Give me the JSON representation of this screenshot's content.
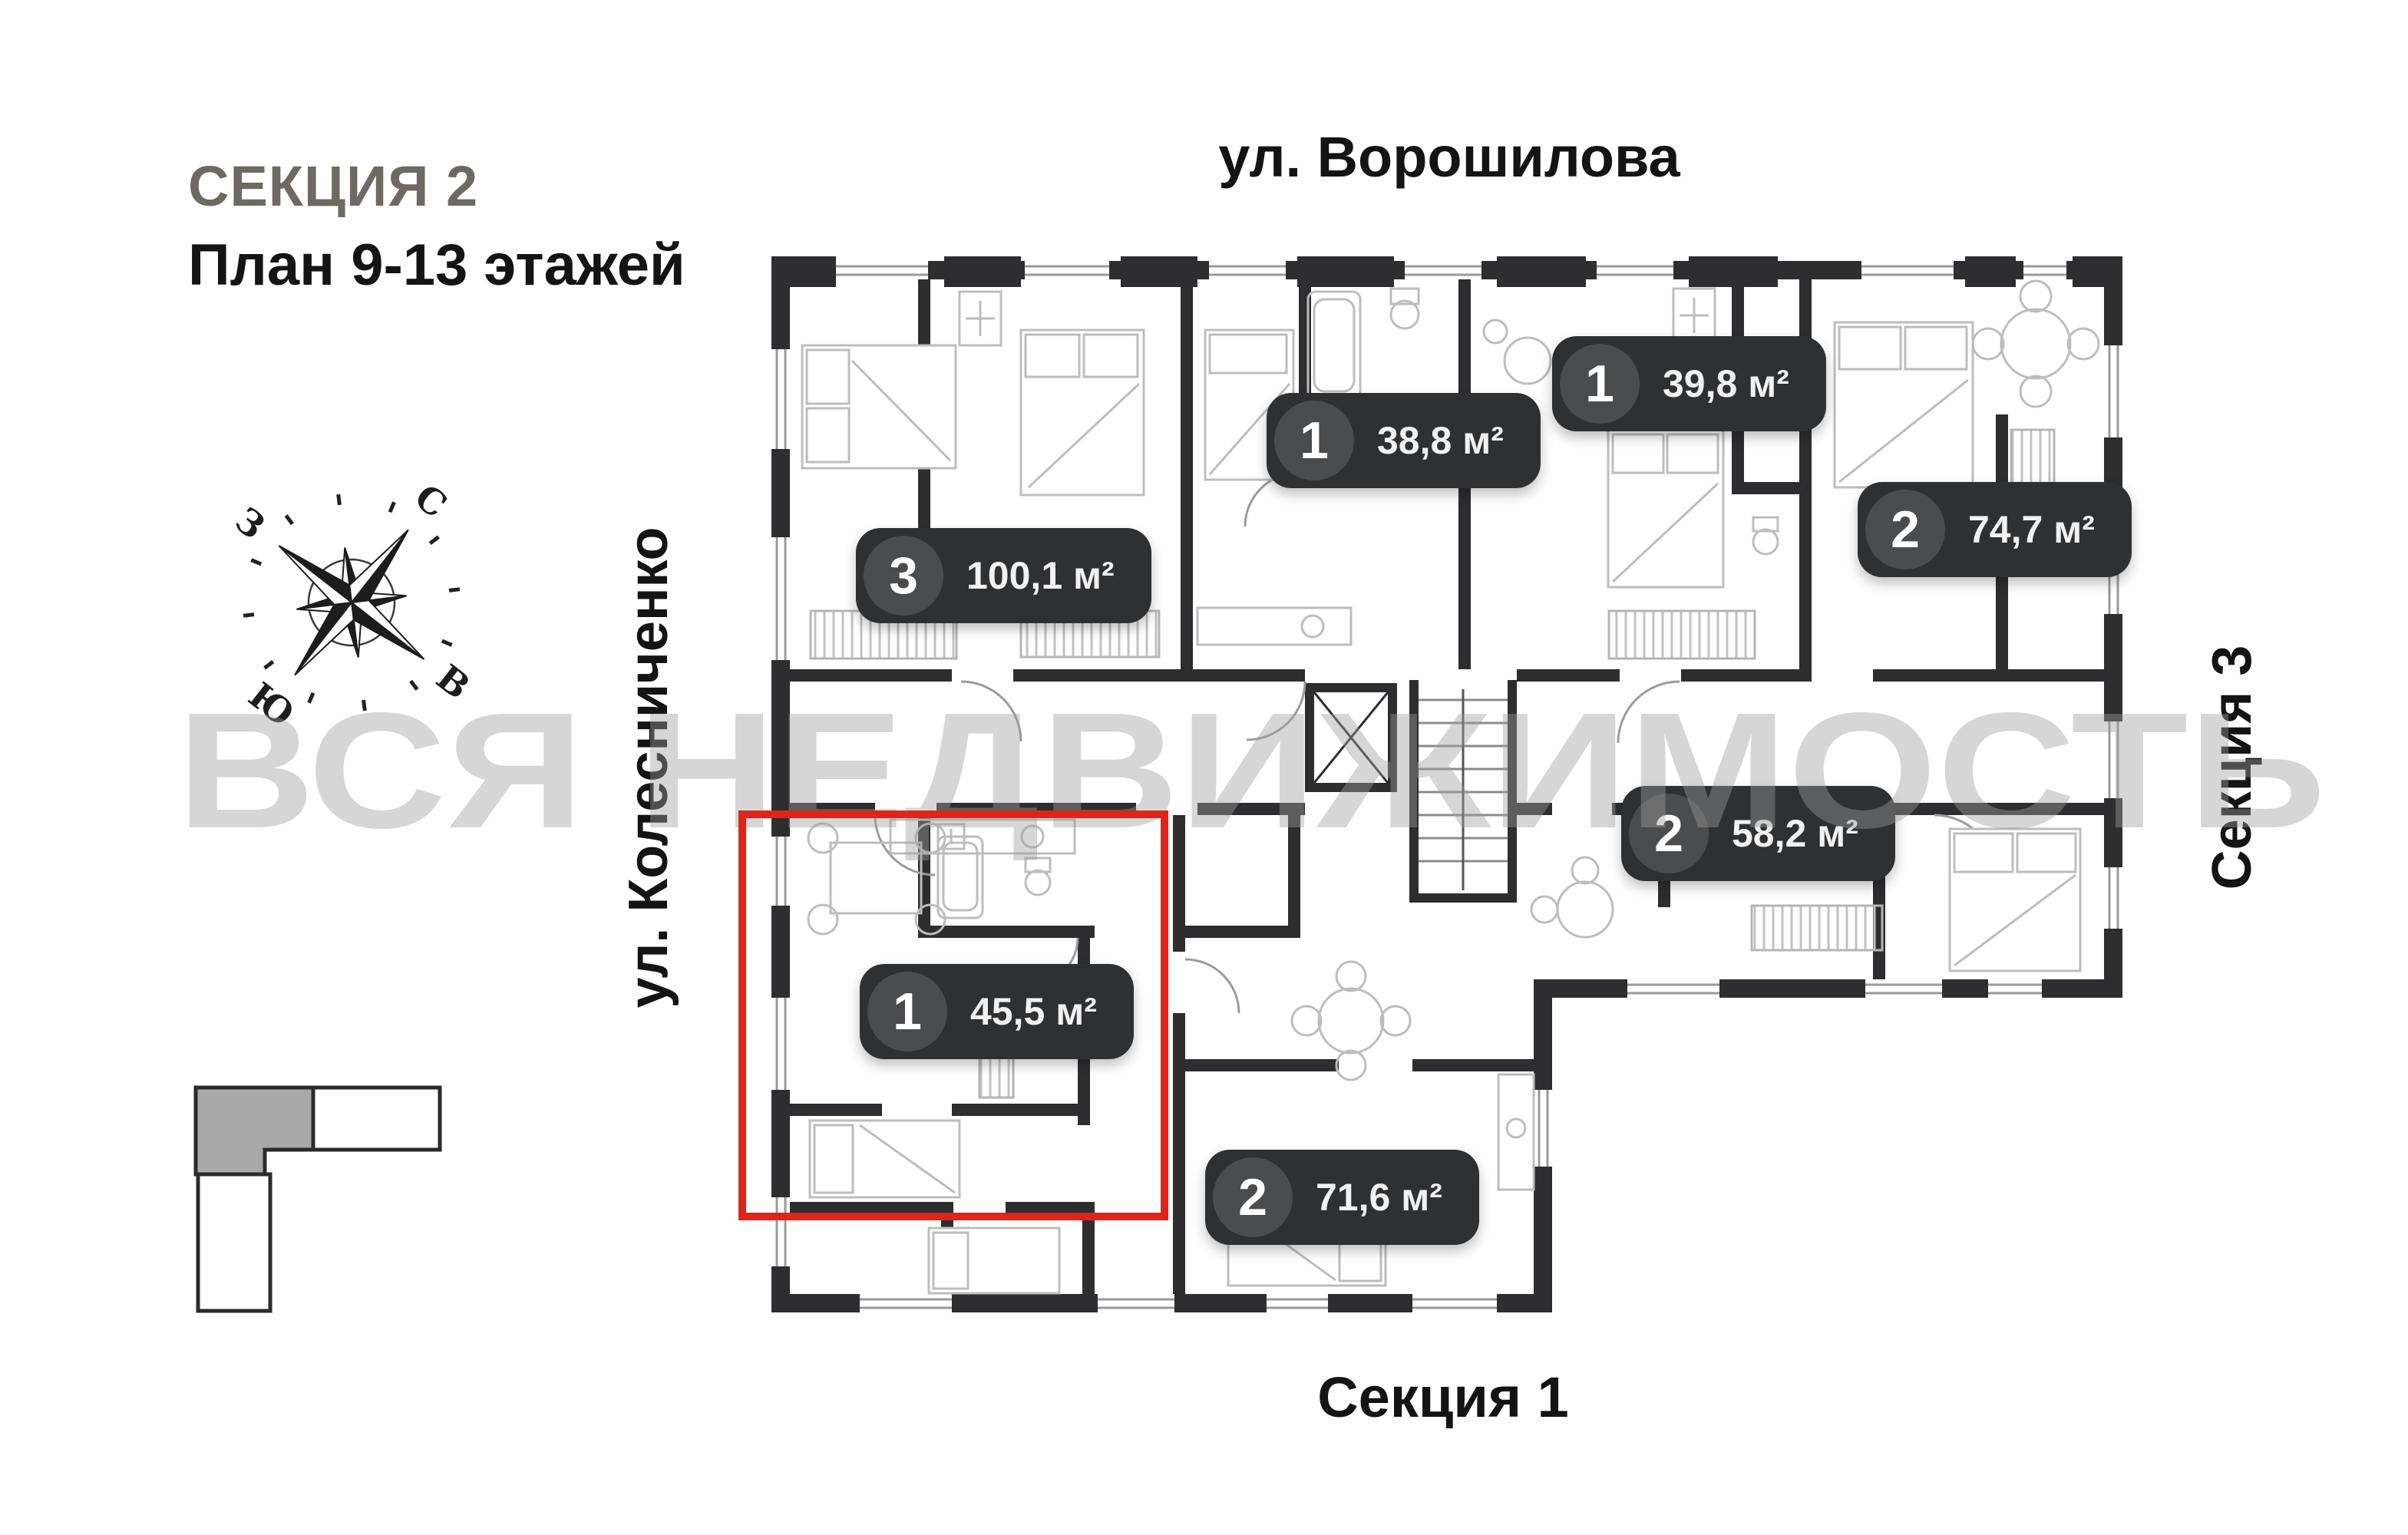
{
  "header": {
    "section_title": "СЕКЦИЯ 2",
    "plan_subtitle": "План 9-13 этажей"
  },
  "streets": {
    "top": "ул. Ворошилова",
    "left": "ул. Колесниченко"
  },
  "sections": {
    "right": "Секция 3",
    "bottom": "Секция 1"
  },
  "compass": {
    "north": "С",
    "south": "Ю",
    "west": "З",
    "east": "В"
  },
  "watermark": "ВСЯ НЕДВИЖИМОСТЬ",
  "apartments": [
    {
      "rooms": "3",
      "area": "100,1 м²",
      "highlighted": false
    },
    {
      "rooms": "1",
      "area": "38,8 м²",
      "highlighted": false
    },
    {
      "rooms": "1",
      "area": "39,8 м²",
      "highlighted": false
    },
    {
      "rooms": "2",
      "area": "74,7 м²",
      "highlighted": false
    },
    {
      "rooms": "2",
      "area": "58,2 м²",
      "highlighted": false
    },
    {
      "rooms": "1",
      "area": "45,5 м²",
      "highlighted": true
    },
    {
      "rooms": "2",
      "area": "71,6 м²",
      "highlighted": false
    }
  ],
  "colors": {
    "highlight": "#e2231a",
    "badge_bg": "#2f3032",
    "badge_circle": "#4b4c4e",
    "wall": "#2e2e30",
    "title_gray": "#6d6963"
  }
}
